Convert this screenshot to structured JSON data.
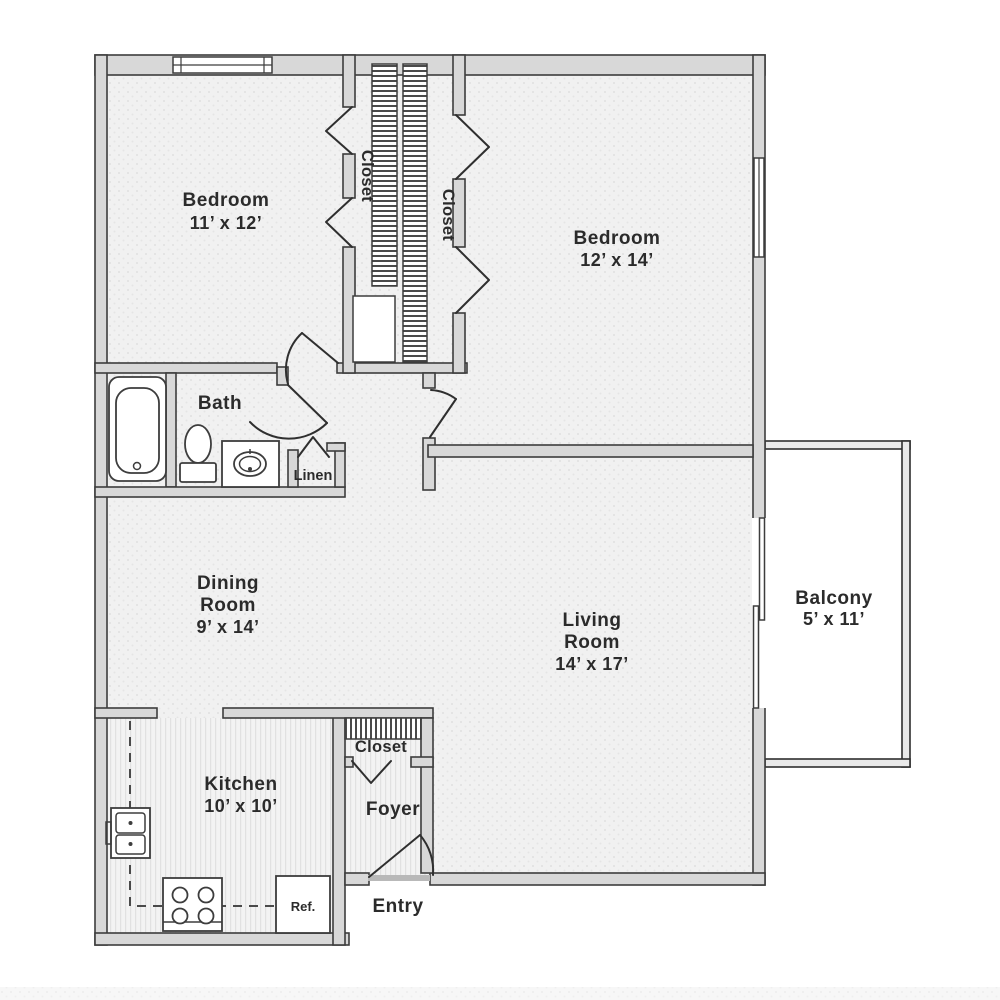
{
  "rooms": {
    "bedroom1": {
      "name": "Bedroom",
      "dims": "11’ x 12’"
    },
    "bedroom2": {
      "name": "Bedroom",
      "dims": "12’ x 14’"
    },
    "dining": {
      "name_line1": "Dining",
      "name_line2": "Room",
      "dims": "9’ x 14’"
    },
    "living": {
      "name_line1": "Living",
      "name_line2": "Room",
      "dims": "14’ x 17’"
    },
    "kitchen": {
      "name": "Kitchen",
      "dims": "10’ x 10’"
    },
    "balcony": {
      "name": "Balcony",
      "dims": "5’ x 11’"
    },
    "bath": {
      "name": "Bath"
    },
    "foyer": {
      "name": "Foyer"
    }
  },
  "closets": {
    "closet_left": "Closet",
    "closet_right": "Closet",
    "foyer_closet": "Closet",
    "linen": "Linen"
  },
  "fixtures": {
    "refrigerator": "Ref."
  },
  "entry_label": "Entry",
  "colors": {
    "wall_fill": "#d8d8d8",
    "wall_line": "#3d3d3d",
    "floor_fill": "#f1f1f1",
    "text": "#2b2b2b",
    "background": "#ffffff"
  }
}
